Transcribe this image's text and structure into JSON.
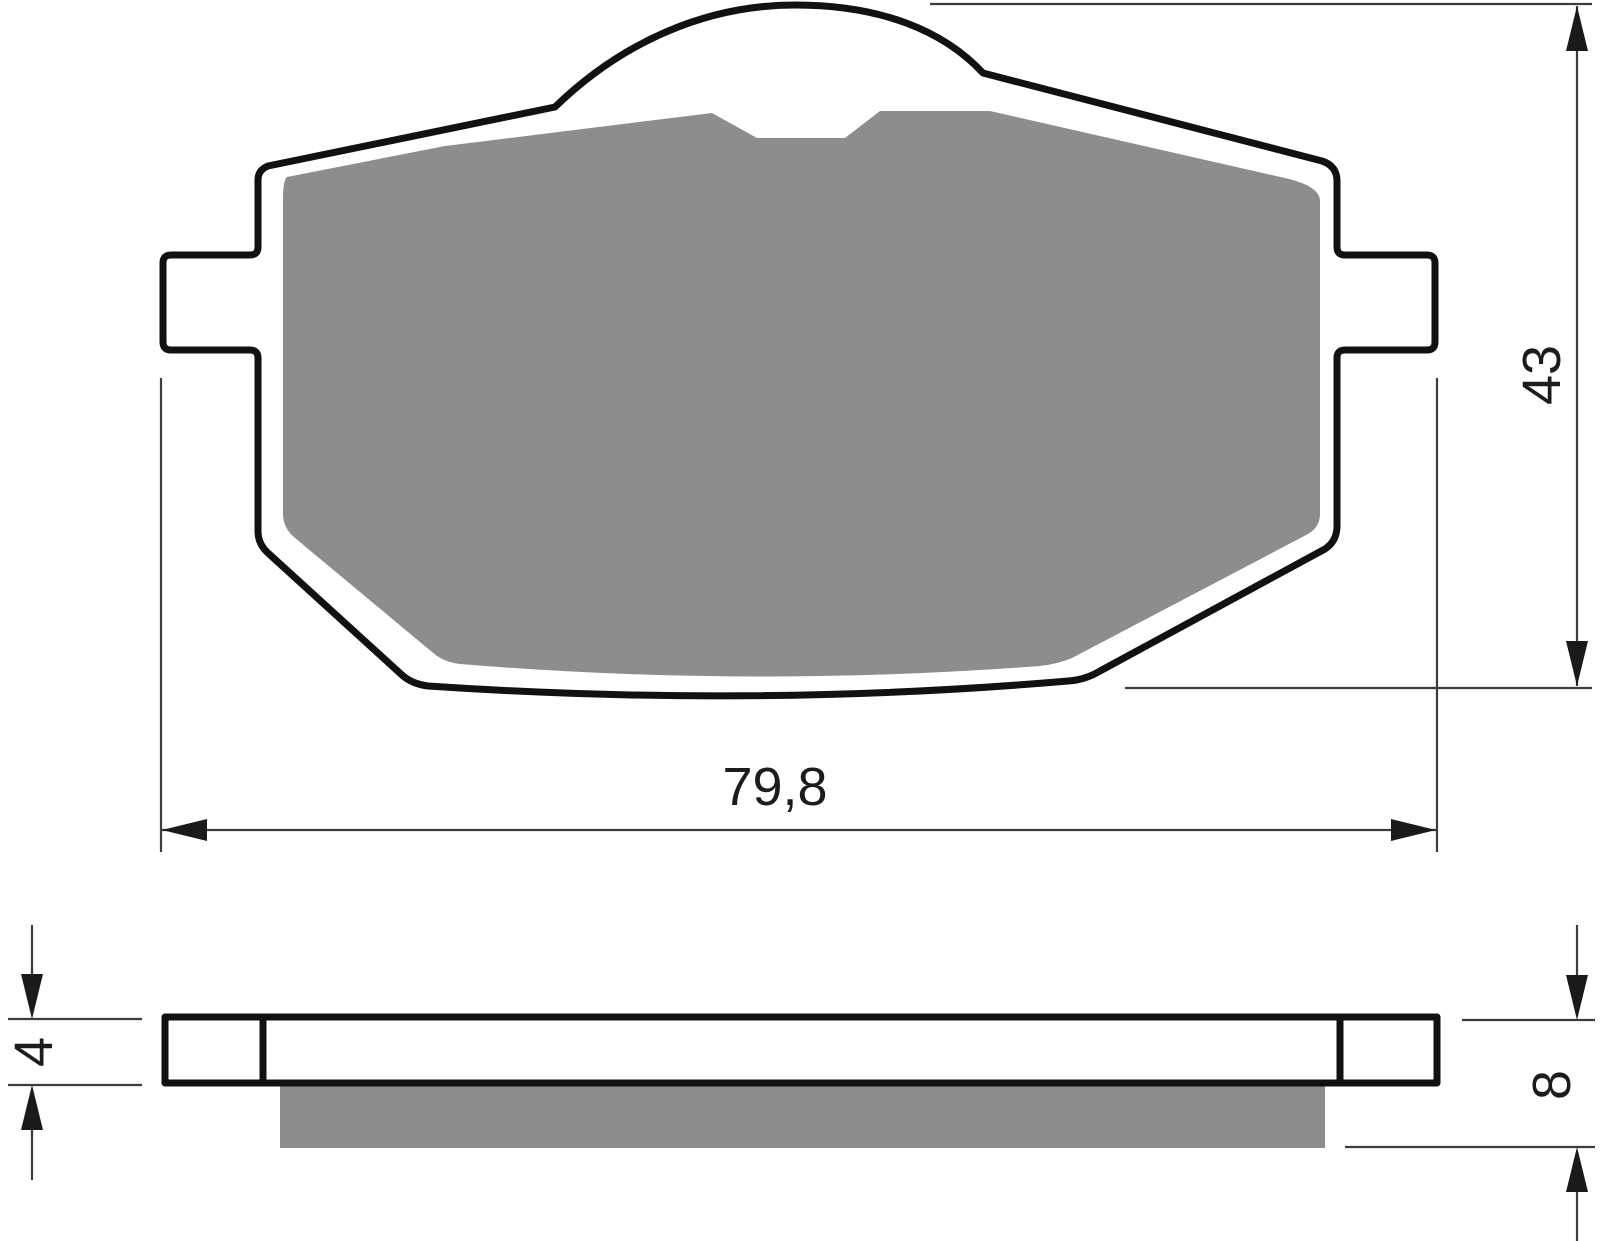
{
  "drawing": {
    "type": "brake-pad-technical-drawing",
    "views": {
      "top_view": "pad outline with friction material",
      "side_view": "pad profile with backing plate and friction material"
    },
    "dimensions": {
      "width_label": "79,8",
      "height_label": "43",
      "plate_thickness_label": "4",
      "total_thickness_label": "8"
    },
    "colors": {
      "background": "#ffffff",
      "outline_stroke": "#111111",
      "friction_material_fill": "#8d8d8d",
      "thin_line": "#3d3d3d",
      "arrow_fill": "#1a1a1a",
      "label_color": "#1c1c1c"
    }
  }
}
